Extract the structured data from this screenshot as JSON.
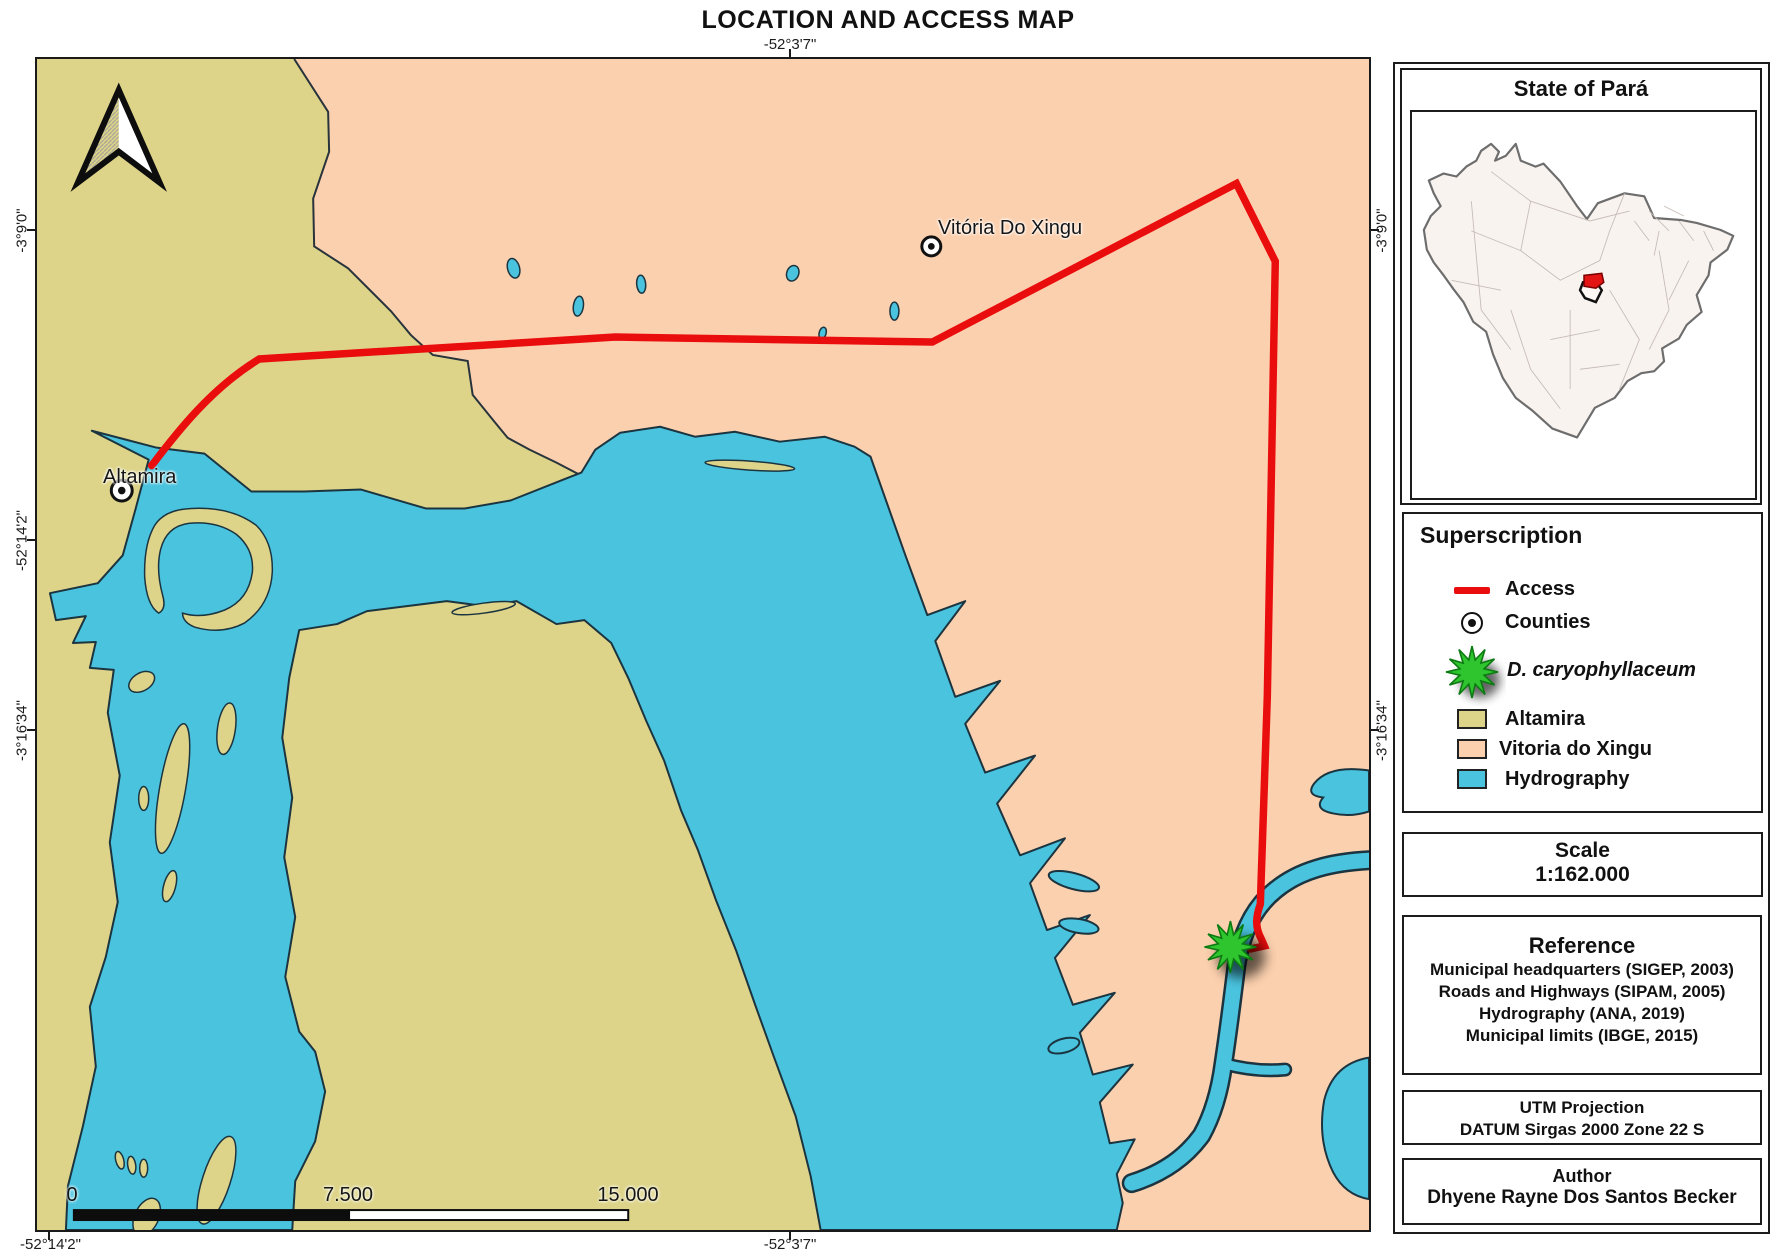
{
  "title": "LOCATION AND ACCESS MAP",
  "colors": {
    "altamira_fill": "#ddd489",
    "vitoria_fill": "#fbd0ae",
    "water_fill": "#4ac3de",
    "water_outline": "#1b3440",
    "route_red": "#ea0d0d",
    "star_green": "#2fc52f"
  },
  "map": {
    "cities": {
      "altamira": "Altamira",
      "vitoria": "Vitória Do Xingu"
    },
    "axis": {
      "top": "-52°3'7\"",
      "left_top": "-3°9'0\"",
      "left_mid": "-52°14'2\"",
      "left_bottom": "-3°16'34\"",
      "right_top": "-3°9'0\"",
      "right_bottom": "-3°16'34\"",
      "bottom_left": "-52°14'2\"",
      "bottom_center": "-52°3'7\""
    },
    "scalebar": {
      "zero": "0",
      "mid": "7.500",
      "max": "15.000"
    }
  },
  "sidebar": {
    "inset": {
      "title": "State of Pará"
    },
    "legend": {
      "title": "Superscription",
      "access": "Access",
      "counties": "Counties",
      "species": "D. caryophyllaceum",
      "altamira": "Altamira",
      "vitoria": "Vitoria do Xingu",
      "hydrography": "Hydrography"
    },
    "scale": {
      "title": "Scale",
      "value": "1:162.000"
    },
    "reference": {
      "title": "Reference",
      "lines": [
        "Municipal headquarters (SIGEP, 2003)",
        "Roads and Highways (SIPAM, 2005)",
        "Hydrography (ANA, 2019)",
        "Municipal limits (IBGE, 2015)"
      ]
    },
    "projection": {
      "line1": "UTM Projection",
      "line2": "DATUM Sirgas 2000 Zone 22 S"
    },
    "author": {
      "title": "Author",
      "name": "Dhyene Rayne Dos Santos Becker"
    }
  }
}
